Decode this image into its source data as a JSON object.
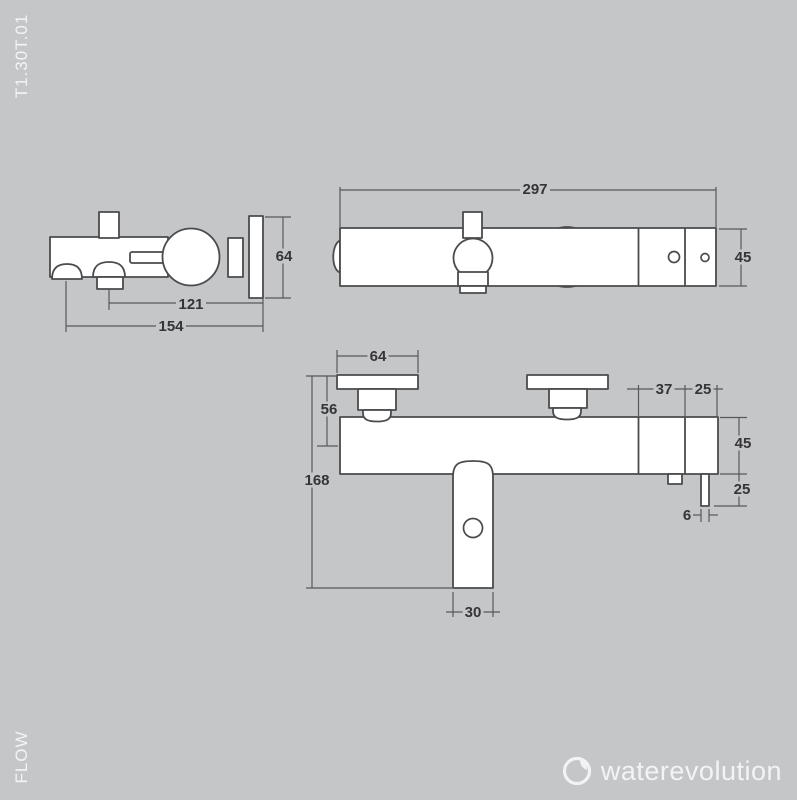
{
  "page": {
    "sheet_code": "T1.30T.01",
    "series_label": "FLOW"
  },
  "brand": {
    "name": "waterevolution",
    "icon": "water-drop-ring-icon",
    "text_color": "#f2f3f5"
  },
  "colors": {
    "background": "#c5c6c8",
    "drawing_line": "#4a4b4d",
    "dimension_line": "#57585b",
    "dimension_text": "#353538",
    "shape_fill": "#ffffff",
    "label_text": "#f3f4f6"
  },
  "views": {
    "side": {
      "title": "side view",
      "dims": {
        "plate_height": "64",
        "valve_to_wall": "121",
        "spout_to_wall": "154"
      }
    },
    "top": {
      "title": "top view",
      "dims": {
        "total_width": "297",
        "body_depth": "45"
      }
    },
    "front": {
      "title": "front view",
      "dims": {
        "escutcheon_width": "64",
        "top_to_axis": "56",
        "total_height": "168",
        "right_seg_a": "37",
        "right_seg_b": "25",
        "body_height": "45",
        "outlet_drop": "25",
        "outlet_width": "6",
        "spout_width": "30"
      }
    }
  }
}
